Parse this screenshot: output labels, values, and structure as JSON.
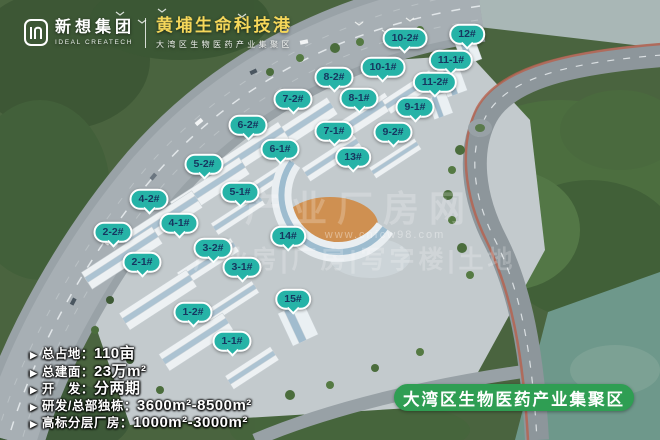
{
  "header": {
    "logo_cn": "新想集团",
    "logo_en": "IDEAL CREATECH",
    "title": "黄埔生命科技港",
    "subtitle": "大湾区生物医药产业集聚区"
  },
  "markers": [
    {
      "text": "10-2#",
      "x": 405,
      "y": 38
    },
    {
      "text": "12#",
      "x": 467,
      "y": 34
    },
    {
      "text": "11-1#",
      "x": 451,
      "y": 60
    },
    {
      "text": "10-1#",
      "x": 383,
      "y": 67
    },
    {
      "text": "8-2#",
      "x": 334,
      "y": 77
    },
    {
      "text": "11-2#",
      "x": 435,
      "y": 82
    },
    {
      "text": "7-2#",
      "x": 293,
      "y": 99
    },
    {
      "text": "8-1#",
      "x": 359,
      "y": 98
    },
    {
      "text": "9-1#",
      "x": 415,
      "y": 107
    },
    {
      "text": "6-2#",
      "x": 248,
      "y": 125
    },
    {
      "text": "7-1#",
      "x": 334,
      "y": 131
    },
    {
      "text": "9-2#",
      "x": 393,
      "y": 132
    },
    {
      "text": "6-1#",
      "x": 280,
      "y": 149
    },
    {
      "text": "13#",
      "x": 353,
      "y": 157
    },
    {
      "text": "5-2#",
      "x": 204,
      "y": 164
    },
    {
      "text": "5-1#",
      "x": 240,
      "y": 192
    },
    {
      "text": "4-2#",
      "x": 149,
      "y": 199
    },
    {
      "text": "4-1#",
      "x": 179,
      "y": 223
    },
    {
      "text": "2-2#",
      "x": 113,
      "y": 232
    },
    {
      "text": "14#",
      "x": 288,
      "y": 236
    },
    {
      "text": "3-2#",
      "x": 213,
      "y": 248
    },
    {
      "text": "2-1#",
      "x": 142,
      "y": 262
    },
    {
      "text": "3-1#",
      "x": 242,
      "y": 267
    },
    {
      "text": "15#",
      "x": 293,
      "y": 299
    },
    {
      "text": "1-2#",
      "x": 193,
      "y": 312
    },
    {
      "text": "1-1#",
      "x": 232,
      "y": 341
    }
  ],
  "stats": {
    "bullet": "▶",
    "items": [
      {
        "label": "总占地：",
        "value": "110亩"
      },
      {
        "label": "总建面：",
        "value": "23万m²"
      },
      {
        "label": "开　发：",
        "value": "分两期"
      },
      {
        "label": "研发/总部独栋：",
        "value": "3600m²-8500m²"
      },
      {
        "label": "高标分层厂房：",
        "value": "1000m²-3000m²"
      }
    ]
  },
  "footer_banner": {
    "text": "大湾区生物医药产业集聚区"
  },
  "watermark": {
    "line1": "产业厂房网",
    "url": "www.cnfcw98.com",
    "line2": "产业房|厂房|写字楼|土地"
  },
  "colors": {
    "marker_teal": "#26b3a7",
    "marker_text": "#16365f",
    "banner_green": "#2f9e53",
    "title_yellow": "#f5d75a"
  }
}
